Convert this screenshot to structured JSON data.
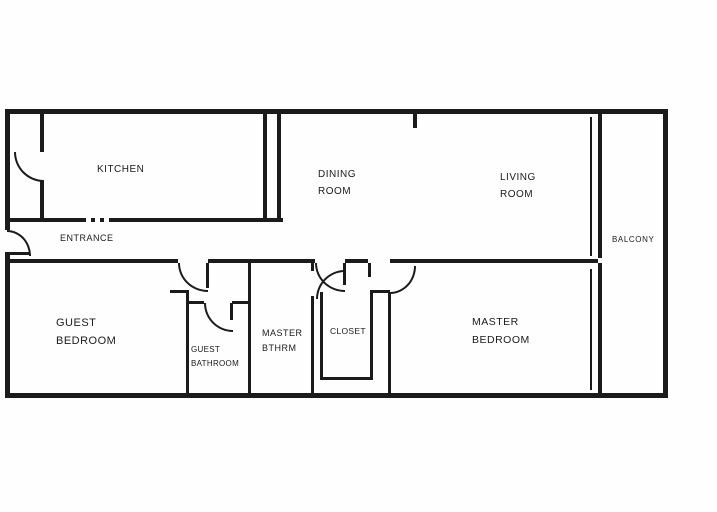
{
  "diagram_type": "apartment-floor-plan",
  "colors": {
    "wall": "#1b1b1b",
    "background": "#ffffff",
    "text": "#1b1b1b"
  },
  "rooms": {
    "kitchen": {
      "label": "KITCHEN"
    },
    "dining_room": {
      "label": "DINING\nROOM"
    },
    "living_room": {
      "label": "LIVING\nROOM"
    },
    "balcony": {
      "label": "BALCONY"
    },
    "entrance": {
      "label": "ENTRANCE"
    },
    "guest_bedroom": {
      "label": "GUEST\nBEDROOM"
    },
    "guest_bathroom": {
      "label": "GUEST\nBATHROOM"
    },
    "master_bathroom": {
      "label": "MASTER\nBTHRM"
    },
    "closet": {
      "label": "CLOSET"
    },
    "master_bedroom": {
      "label": "MASTER\nBEDROOM"
    }
  },
  "features": {
    "doors": [
      "entrance-door",
      "pantry-door",
      "guest-hall-door",
      "guest-bathroom-door",
      "master-hall-door",
      "closet-door",
      "master-bedroom-door"
    ],
    "windows": [
      "living-room-balcony-slider",
      "master-bedroom-window"
    ]
  }
}
